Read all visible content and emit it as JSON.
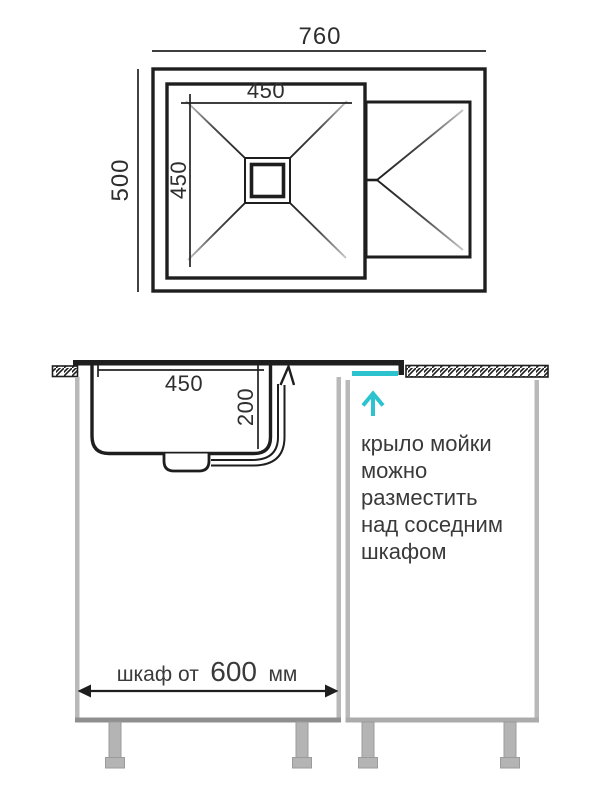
{
  "colors": {
    "accent_cyan": "#2cc3ce",
    "line": "#1e1e1e",
    "text": "#3a3a3a",
    "cabinet_gray": "#b9b9b9"
  },
  "top_view": {
    "overall_width": "760",
    "overall_depth": "500",
    "bowl_width": "450",
    "bowl_depth": "450"
  },
  "section_view": {
    "bowl_inner_width": "450",
    "bowl_depth": "200",
    "cabinet_dim_prefix": "шкаф от",
    "cabinet_dim_value": "600",
    "cabinet_dim_suffix": "мм",
    "annotation": {
      "lines": [
        "крыло мойки",
        "можно",
        "разместить",
        "над соседним",
        "шкафом"
      ]
    }
  }
}
